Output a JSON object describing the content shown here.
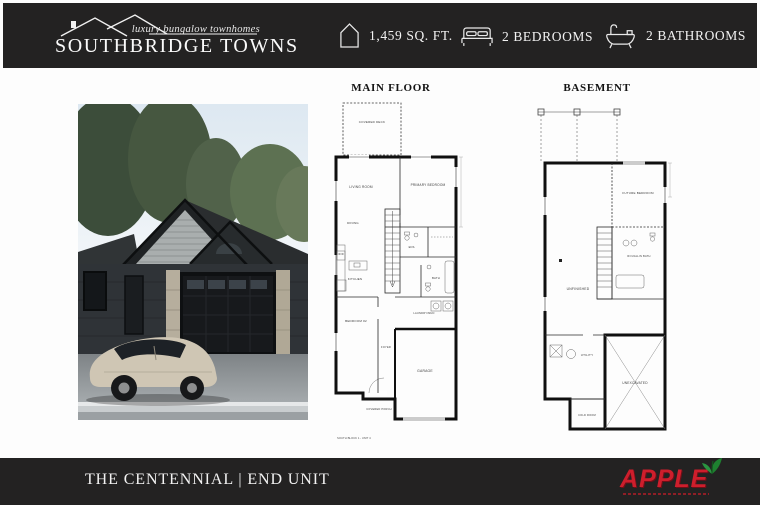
{
  "header": {
    "tagline": "luxury bungalow townhomes",
    "brand": "SOUTHBRIDGE TOWNS",
    "specs": [
      {
        "icon": "house-outline-icon",
        "label": "1,459 SQ. FT."
      },
      {
        "icon": "bed-icon",
        "label": "2 BEDROOMS"
      },
      {
        "icon": "bathtub-icon",
        "label": "2 BATHROOMS"
      }
    ]
  },
  "plans": {
    "main_floor": {
      "title": "MAIN FLOOR",
      "rooms": {
        "covered_deck": "COVERED DECK",
        "living_room": "LIVING ROOM",
        "dining": "DINING",
        "primary_bedroom": "PRIMARY BEDROOM",
        "ensuite": "ENS.",
        "bath": "BATH",
        "kitchen": "KITCHEN",
        "bedroom_2": "BEDROOM #2",
        "laundry": "LAUNDRY/MUD",
        "foyer": "FOYER",
        "garage": "GARAGE",
        "covered_porch": "COVERED PORCH"
      },
      "caption": "SOUTH BLOCK 1 - UNIT 4"
    },
    "basement": {
      "title": "BASEMENT",
      "rooms": {
        "future_bedroom": "FUTURE BEDROOM",
        "rough_in_bath": "ROUGH-IN BATH",
        "unfinished": "UNFINISHED",
        "utility": "UTILITY",
        "cold_room": "COLD ROOM",
        "unexcavated": "UNEXCAVATED"
      }
    }
  },
  "footer": {
    "unit_name": "THE CENTENNIAL | END UNIT",
    "builder": "APPLE"
  },
  "colors": {
    "bar_bg": "#232222",
    "accent_red": "#ce1e2c",
    "leaf_green": "#1e8030"
  }
}
